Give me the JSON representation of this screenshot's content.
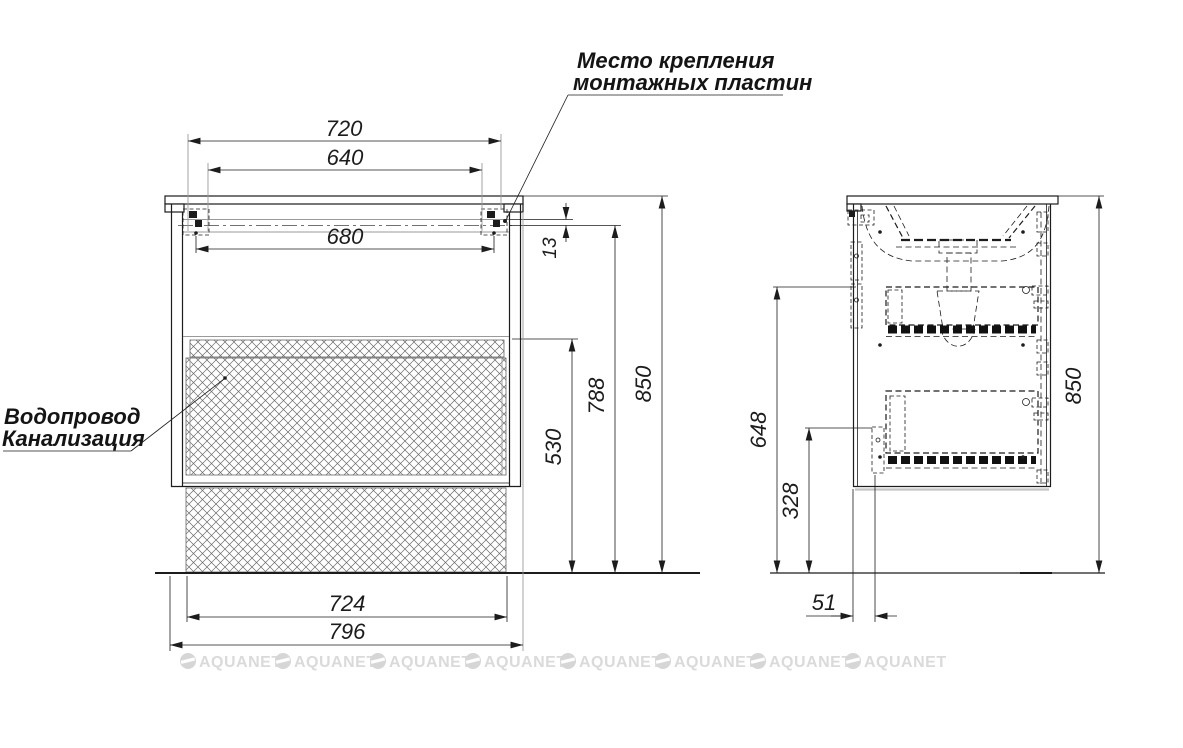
{
  "drawing": {
    "type": "furniture-installation-drawing",
    "views": [
      "front",
      "side"
    ]
  },
  "labels": {
    "mounting_plates_line1": "Место крепления",
    "mounting_plates_line2": "монтажных пластин",
    "plumbing_line1": "Водопровод",
    "plumbing_line2": "Канализация"
  },
  "front_view": {
    "plates_outer_width": "720",
    "plates_inner_width": "640",
    "plates_center_width": "680",
    "rail_offset": "13",
    "mount_height": "788",
    "total_height": "850",
    "clearance_height": "530",
    "body_width": "724",
    "countertop_width": "796"
  },
  "side_view": {
    "upper_mount_height": "648",
    "lower_mount_height": "328",
    "front_offset": "51",
    "total_height": "850"
  },
  "watermark": {
    "text": "AQUANET"
  },
  "colors": {
    "line": "#1c1c1c",
    "aux_line": "#9a9a9a",
    "hatch": "#6a6a6a",
    "watermark": "#dadada",
    "background": "#ffffff"
  }
}
